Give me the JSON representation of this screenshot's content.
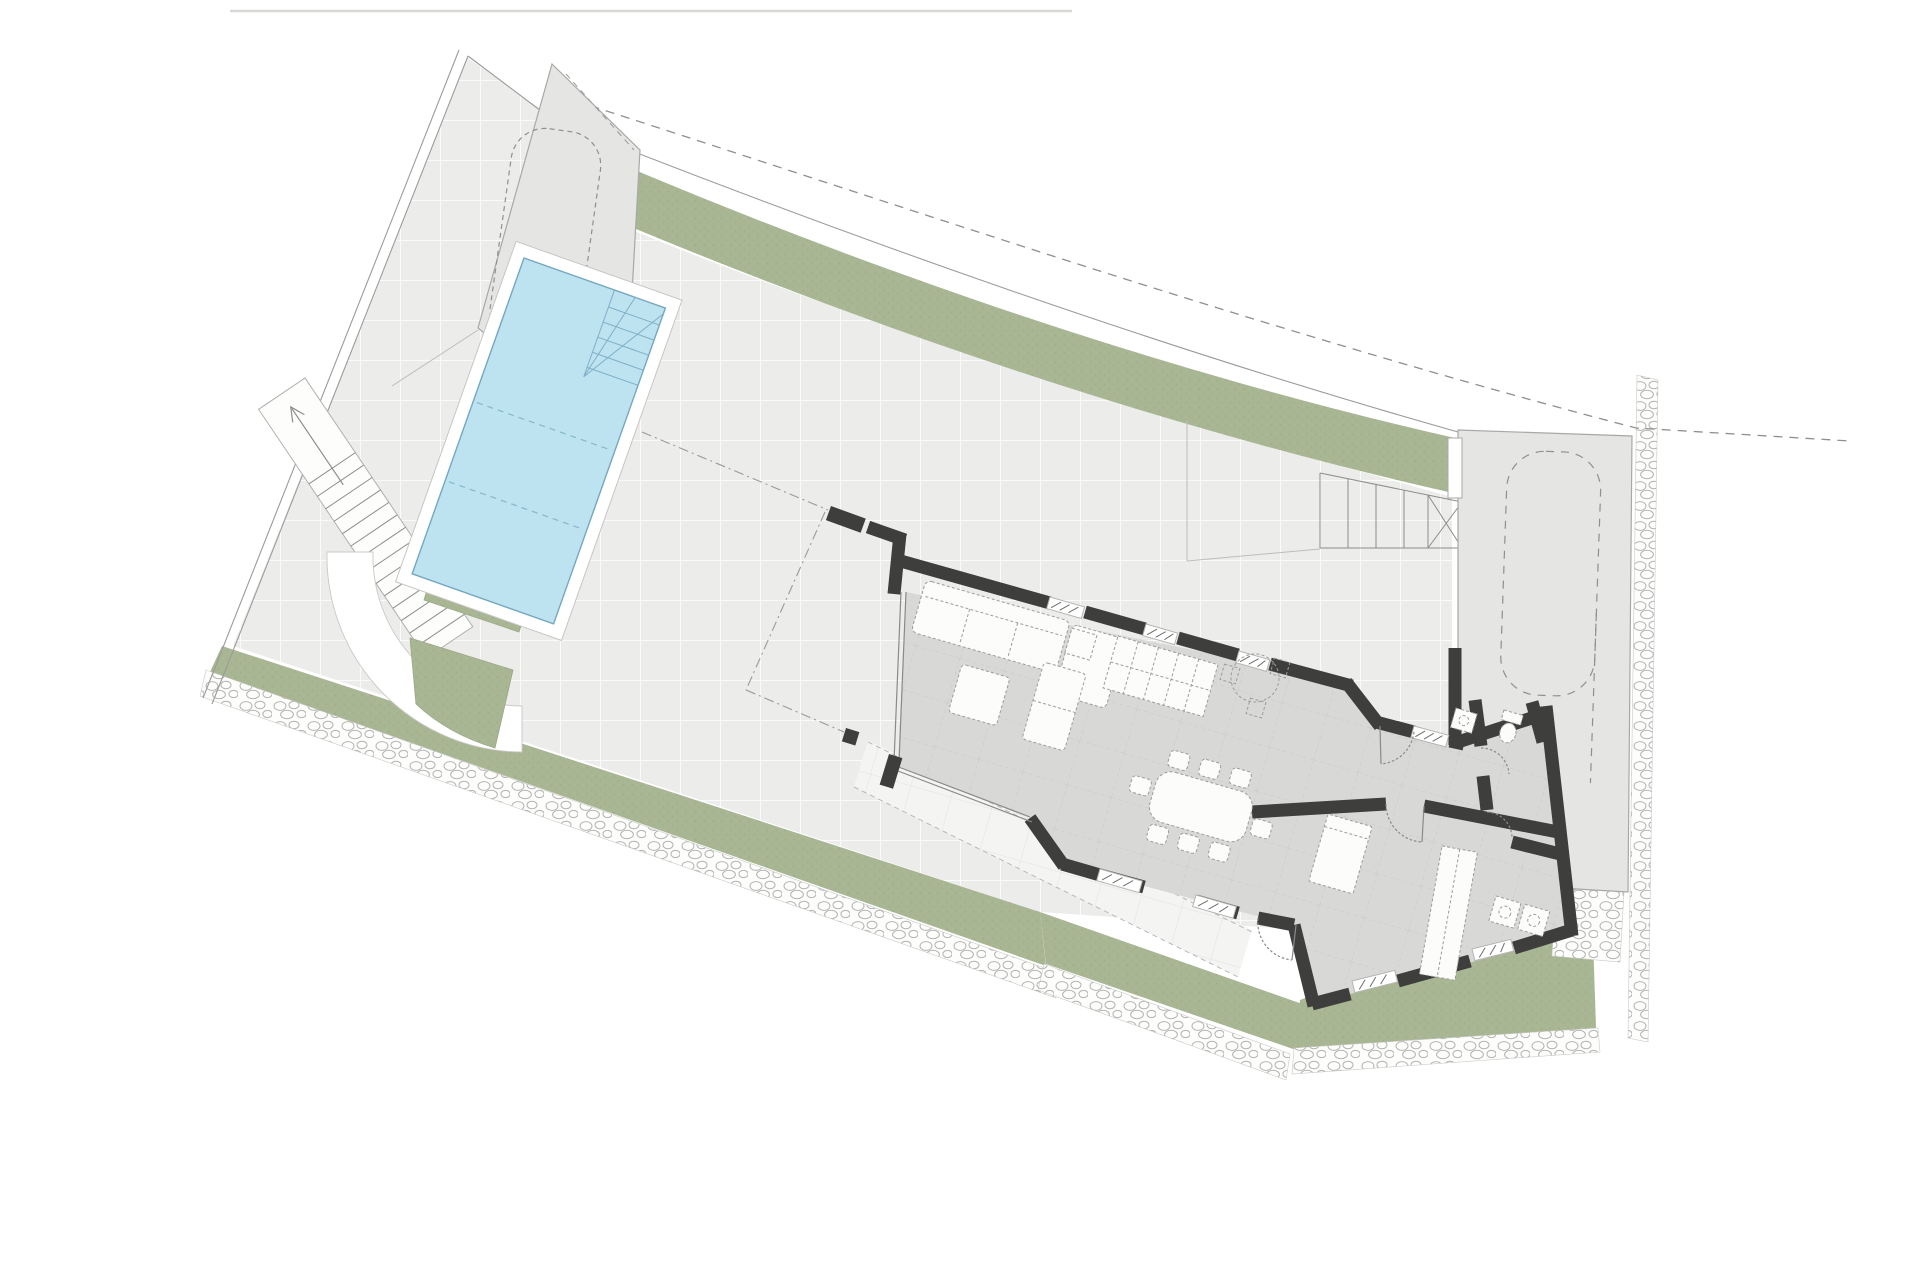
{
  "meta": {
    "title": "Villa ground-floor site plan",
    "drawing_type": "architectural plan, top view",
    "visible_text": "none"
  },
  "colors": {
    "background": "#ffffff",
    "terrace": "#ececea",
    "terrace_grid": "#ffffff",
    "walkway": "#f4f4f3",
    "house_floor": "#d8d8d7",
    "floor_grid": "#c9c9c7",
    "wall": "#3e3e3d",
    "green": "#a9b693",
    "green_dot": "#95a47d",
    "pool_water": "#bde2f0",
    "pool_edge": "#74a8c0",
    "pad": "#e5e5e3",
    "pad_outline": "#a8a8a6",
    "boundary": "#9b9b9b",
    "pebble": "#b3b3b1",
    "furniture": "#fcfcfb"
  },
  "site": {
    "plot": {
      "shape": "irregular, wider at top-left, tapering bottom-right",
      "boundary_style": "thin double line left, solid+dashed curve top, pebble border bottom"
    },
    "features": [
      {
        "name": "parking-pad-top-left",
        "kind": "parking pad",
        "car_outline": "dashed rounded rectangle"
      },
      {
        "name": "green-band-top",
        "kind": "planted strip following curved street boundary"
      },
      {
        "name": "pool",
        "kind": "swimming pool",
        "steps": "corner steps top-right",
        "lane_marks": 2
      },
      {
        "name": "garden-beds-left",
        "kind": "three green planting beds with white paths"
      },
      {
        "name": "curved-path",
        "kind": "white quarter-ring path around beds"
      },
      {
        "name": "exterior-stair-ramp-left",
        "kind": "long stepped ramp with direction arrow"
      },
      {
        "name": "entry-stairs-right",
        "kind": "exterior entry stair with cross mark"
      },
      {
        "name": "driveway-pad-right",
        "kind": "driveway / parking pad",
        "car_outline": "dashed rounded rectangle"
      },
      {
        "name": "green-band-bottom",
        "kind": "planted strip with pebble mulch border"
      },
      {
        "name": "gravel-borders",
        "kind": "pebble/stone drainage strips"
      }
    ],
    "parking_spaces": 2
  },
  "house": {
    "orientation_deg": 16,
    "walls": "dark solid walls with window openings (hatched) and full-height glazing on west and south of living room",
    "rooms": [
      {
        "name": "living-room",
        "furniture": [
          "sofa",
          "chaise",
          "side-table",
          "coffee-table"
        ]
      },
      {
        "name": "kitchen",
        "furniture": [
          "island-block-2x5",
          "dashed-breakfast-nook"
        ]
      },
      {
        "name": "dining-area",
        "furniture": [
          "dining-table"
        ],
        "chairs": 8
      },
      {
        "name": "entry-hall",
        "doors": [
          "entry-door",
          "south-entrance-door"
        ]
      },
      {
        "name": "wc",
        "furniture": [
          "toilet",
          "sink"
        ]
      },
      {
        "name": "bathroom",
        "furniture": [
          "double-sink"
        ]
      },
      {
        "name": "bedroom",
        "furniture": [
          "bed",
          "wardrobe"
        ]
      }
    ],
    "patio_nw": {
      "style": "dash-dot outline with two dark wall piers"
    }
  }
}
